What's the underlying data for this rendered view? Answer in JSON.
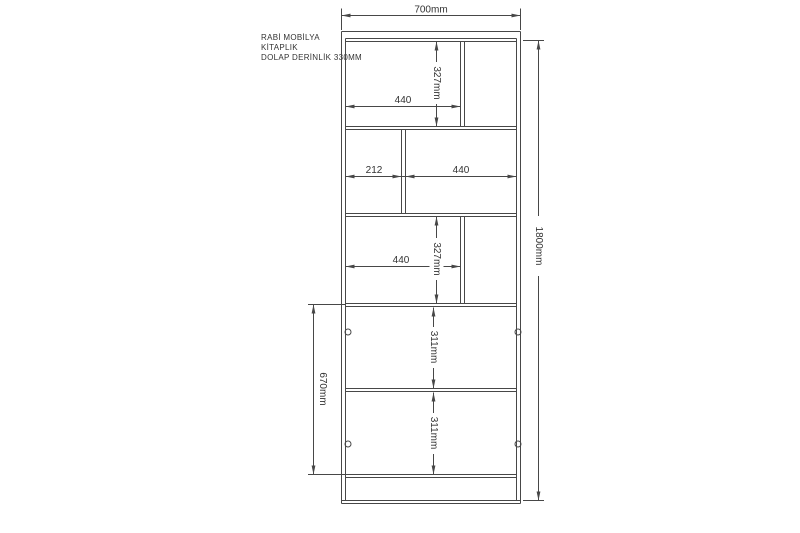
{
  "colors": {
    "line": "#474747",
    "text": "#333333",
    "background": "#ffffff"
  },
  "title_block": {
    "brand": "RABİ MOBİLYA",
    "product": "KİTAPLIK",
    "depth_note": "DOLAP DERİNLİK 330MM"
  },
  "dimensions": {
    "overall_width": "700mm",
    "overall_height": "1800mm",
    "door_column_height": "670mm",
    "top_shelf": {
      "width": "440",
      "height": "327mm"
    },
    "second_shelf": {
      "left_width": "212",
      "right_width": "440"
    },
    "third_shelf": {
      "width": "440",
      "height": "327mm"
    },
    "upper_door": {
      "height": "311mm"
    },
    "lower_door": {
      "height": "311mm"
    }
  }
}
